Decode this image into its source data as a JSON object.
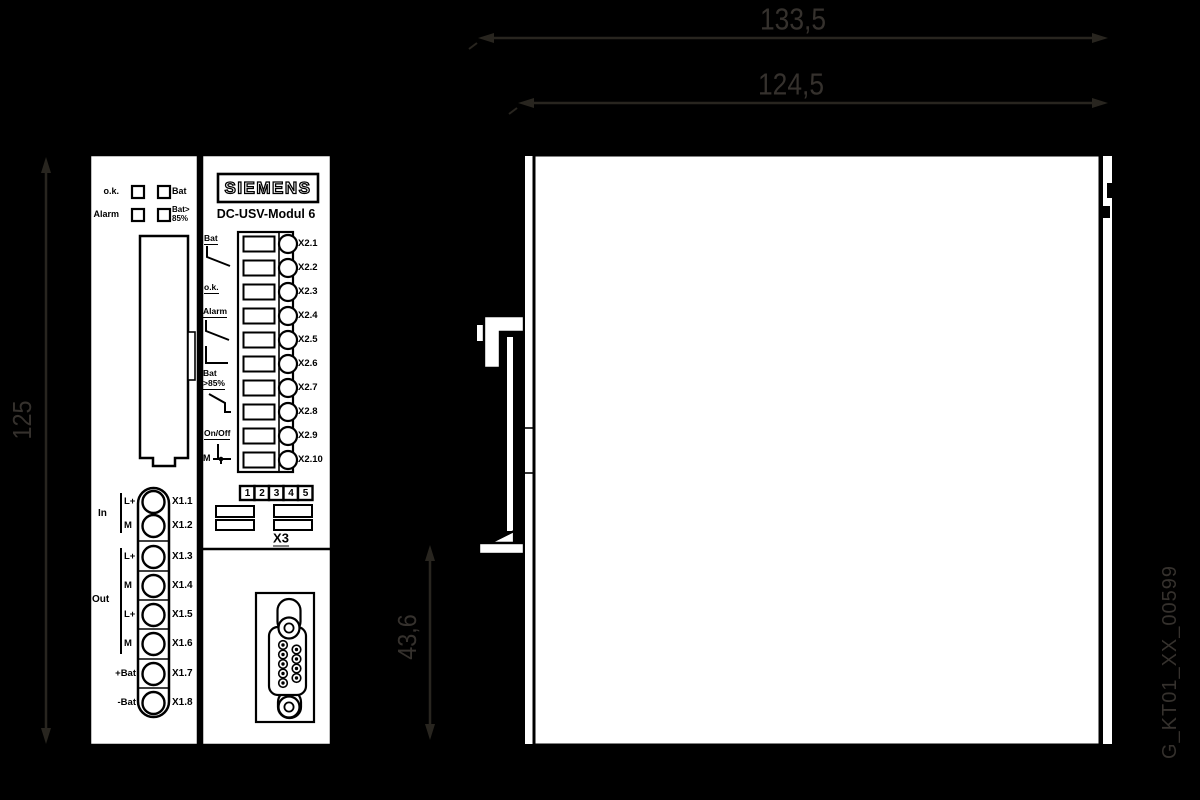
{
  "dims": {
    "overall_width": "133,5",
    "body_width": "124,5",
    "height": "125",
    "rail_offset": "43,6"
  },
  "drawing_number": "G_KT01_XX_00599",
  "front": {
    "brand": "SIEMENS",
    "model": "DC-USV-Modul 6",
    "leds": {
      "ok": "o.k.",
      "bat": "Bat",
      "alarm": "Alarm",
      "bat85a": "Bat>",
      "bat85b": "85%"
    },
    "x1": {
      "group_in": "In",
      "group_out": "Out",
      "pins": [
        "L+",
        "M",
        "L+",
        "M",
        "L+",
        "M",
        "+Bat",
        "-Bat"
      ],
      "terminals": [
        "X1.1",
        "X1.2",
        "X1.3",
        "X1.4",
        "X1.5",
        "X1.6",
        "X1.7",
        "X1.8"
      ]
    },
    "x2": {
      "sig_bat": "Bat",
      "sig_ok": "o.k.",
      "sig_alarm": "Alarm",
      "sig_bat2": "Bat",
      "sig_bat85": ">85%",
      "sig_onoff": "On/Off",
      "sig_m": "M",
      "terminals": [
        "X2.1",
        "X2.2",
        "X2.3",
        "X2.4",
        "X2.5",
        "X2.6",
        "X2.7",
        "X2.8",
        "X2.9",
        "X2.10"
      ]
    },
    "x3": {
      "label": "X3",
      "dip": [
        "1",
        "2",
        "3",
        "4",
        "5"
      ]
    }
  },
  "colors": {
    "background": "#000000",
    "panel": "#ffffff",
    "line": "#000000",
    "dimension": "#35312d"
  }
}
